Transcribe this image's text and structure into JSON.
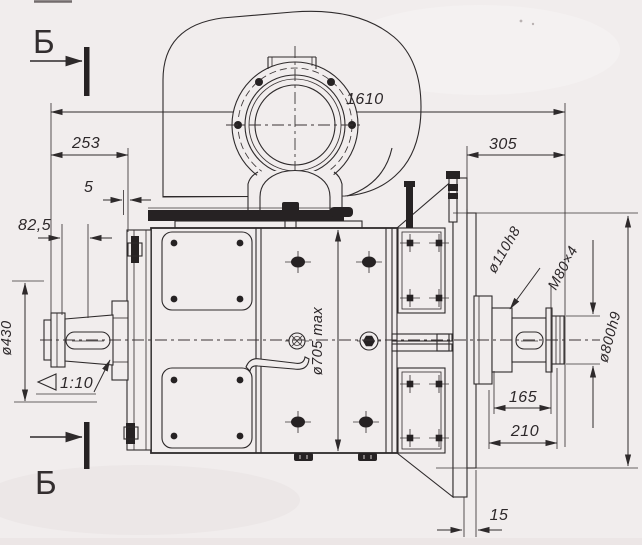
{
  "section_markers": {
    "top": "Б",
    "bottom": "Б"
  },
  "dimensions": {
    "overall_length": "1610",
    "left_to_flange": "253",
    "gap": "5",
    "shaft_end_left": "82,5",
    "right_offset": "305",
    "left_hub_diameter": "ø430",
    "taper": "1:10",
    "frame_diameter": "ø705 max",
    "shaft_seat_diameter": "ø110h8",
    "thread": "M80×4",
    "flange_diameter": "ø800h9",
    "shaft_cylinder_length": "165",
    "shaft_extension_length": "210",
    "flange_offset": "15"
  }
}
